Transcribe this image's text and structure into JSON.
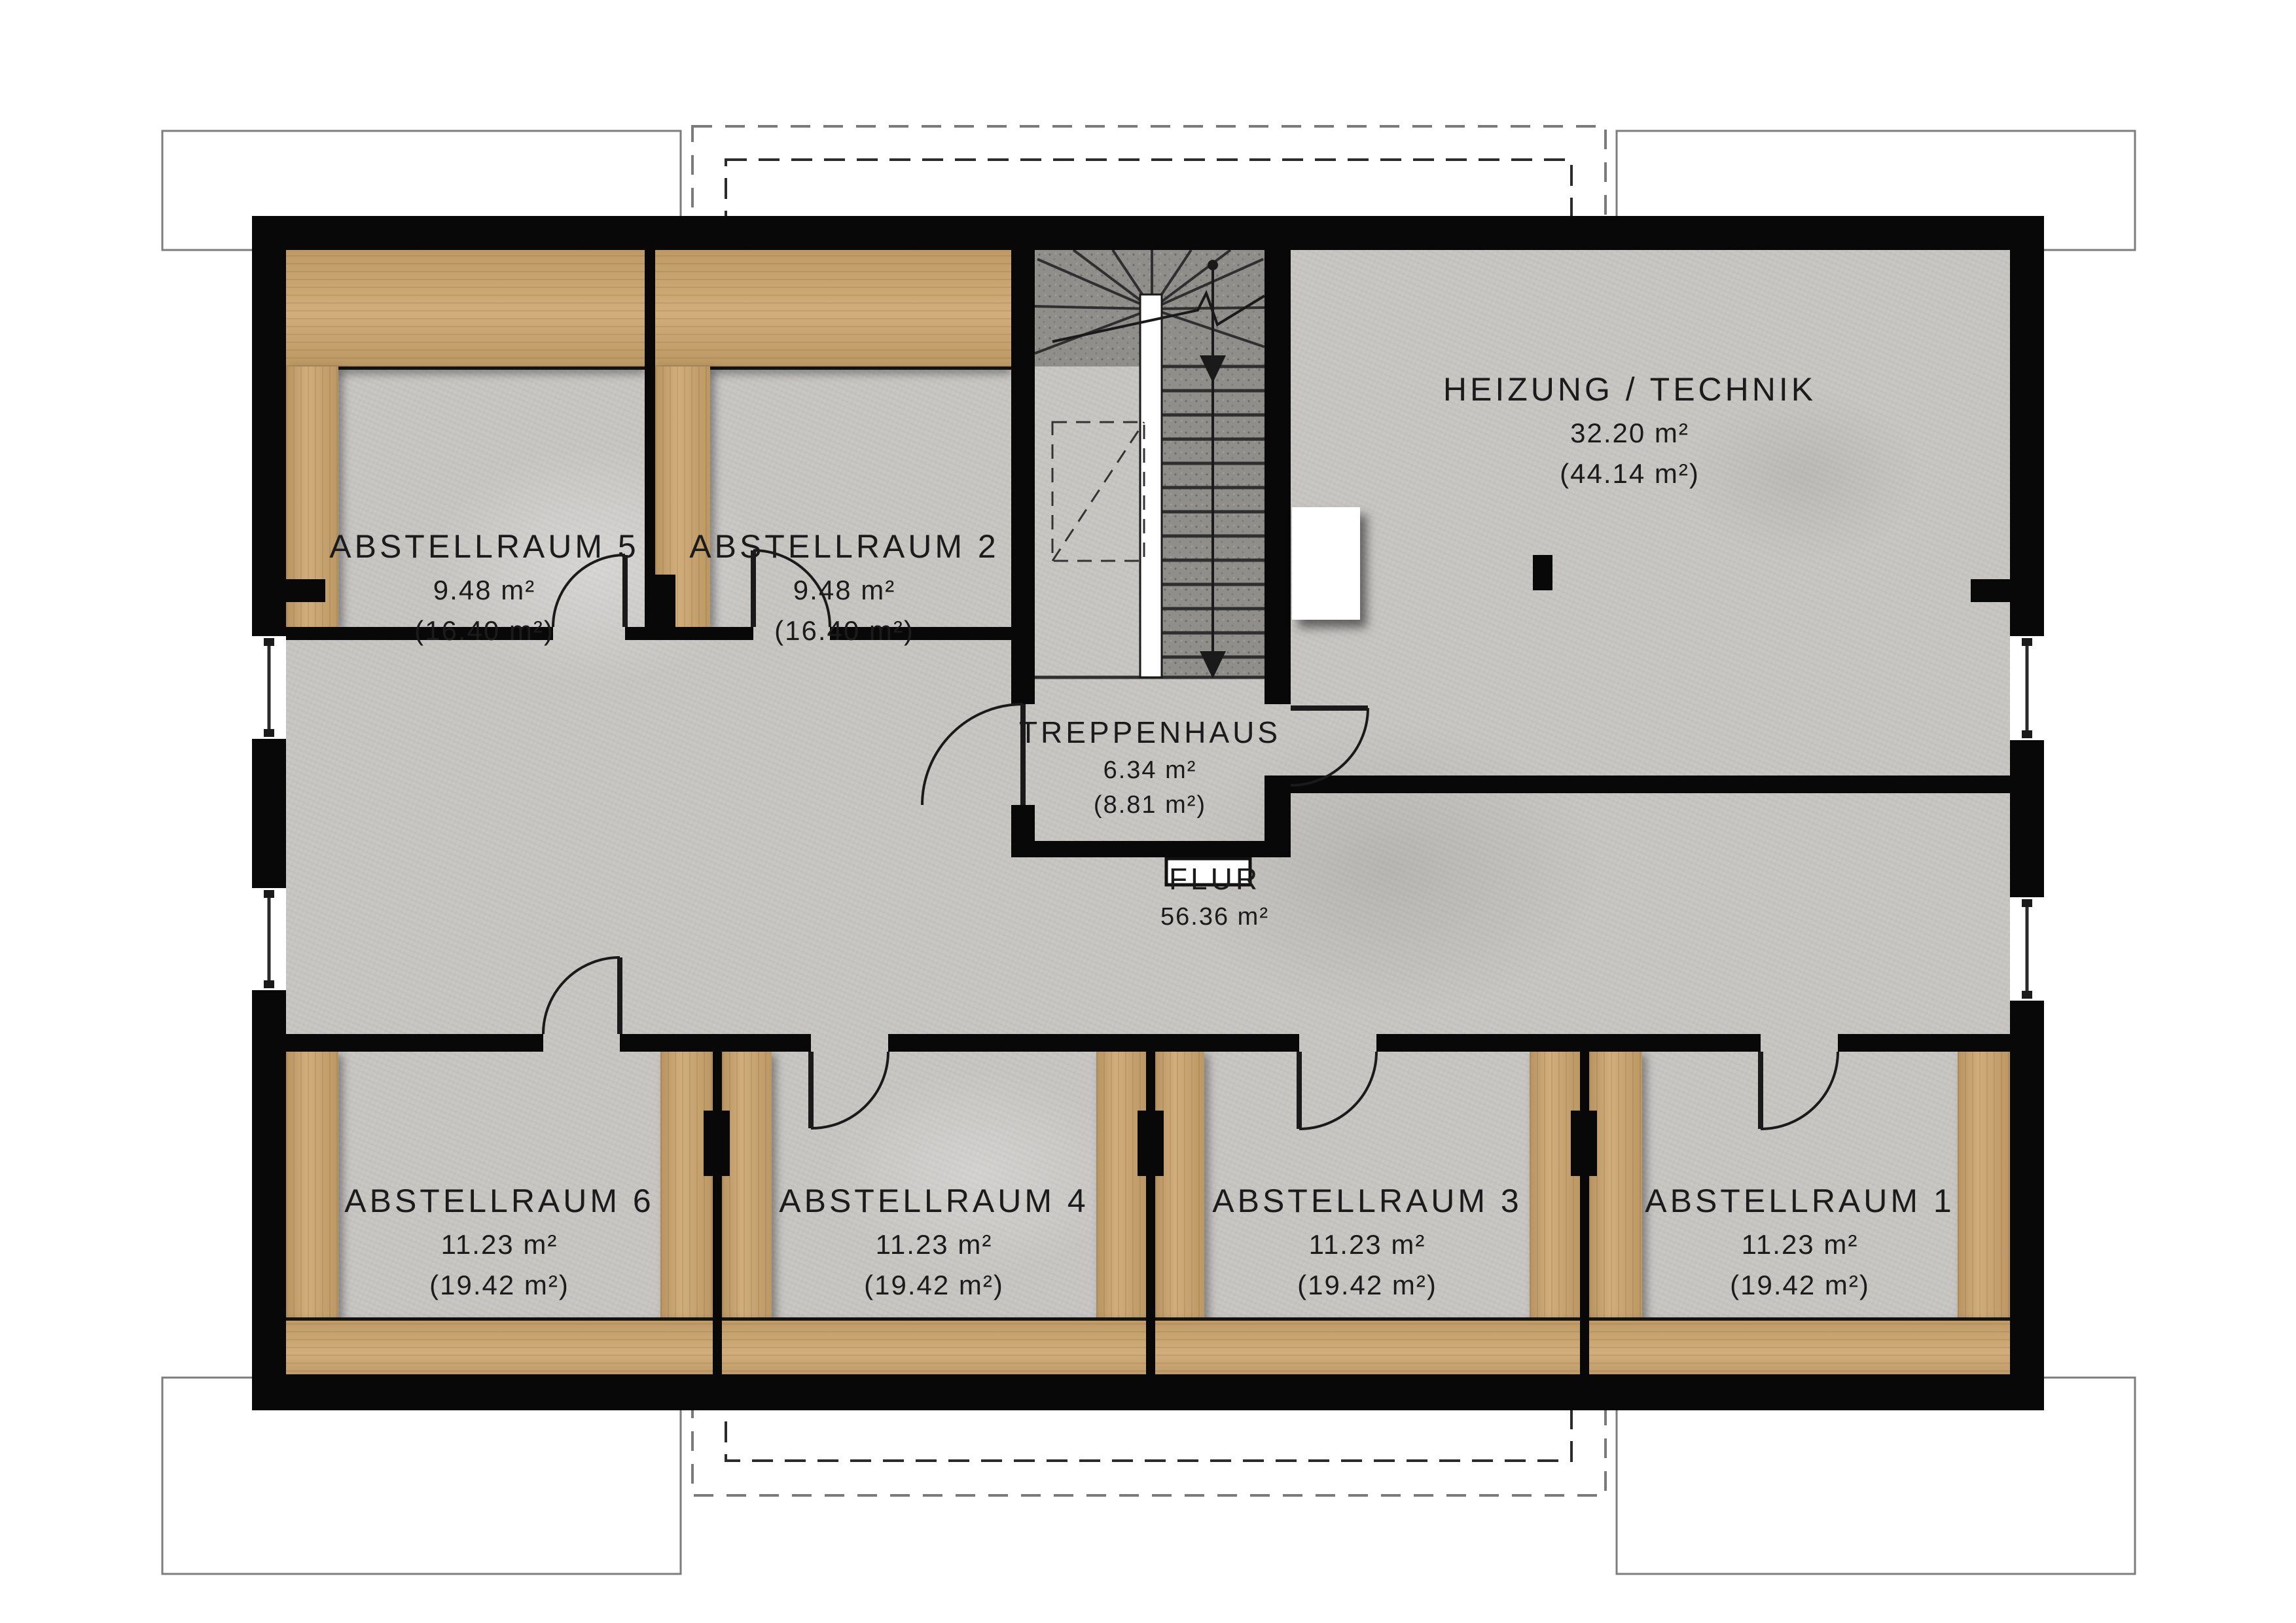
{
  "colors": {
    "wall": "#080808",
    "wood": "#cba46c",
    "floor": "#c7c5c2",
    "stair_tread": "#8f8e8b",
    "paper": "#ffffff",
    "line": "#1a1a1a",
    "dashed_outer": "#7a7a7a",
    "dashed_inner": "#2b2b2b"
  },
  "rooms": [
    {
      "key": "abstellraum5",
      "name": "ABSTELLRAUM 5",
      "area": "9.48 m²",
      "gross": "(16.40 m²)"
    },
    {
      "key": "abstellraum2",
      "name": "ABSTELLRAUM 2",
      "area": "9.48 m²",
      "gross": "(16.40 m²)"
    },
    {
      "key": "heizung_technik",
      "name": "HEIZUNG / TECHNIK",
      "area": "32.20 m²",
      "gross": "(44.14 m²)"
    },
    {
      "key": "treppenhaus",
      "name": "TREPPENHAUS",
      "area": "6.34 m²",
      "gross": "(8.81 m²)"
    },
    {
      "key": "flur",
      "name": "FLUR",
      "area": "56.36 m²",
      "gross": ""
    },
    {
      "key": "abstellraum6",
      "name": "ABSTELLRAUM 6",
      "area": "11.23 m²",
      "gross": "(19.42 m²)"
    },
    {
      "key": "abstellraum4",
      "name": "ABSTELLRAUM 4",
      "area": "11.23 m²",
      "gross": "(19.42 m²)"
    },
    {
      "key": "abstellraum3",
      "name": "ABSTELLRAUM 3",
      "area": "11.23 m²",
      "gross": "(19.42 m²)"
    },
    {
      "key": "abstellraum1",
      "name": "ABSTELLRAUM 1",
      "area": "11.23 m²",
      "gross": "(19.42 m²)"
    }
  ]
}
